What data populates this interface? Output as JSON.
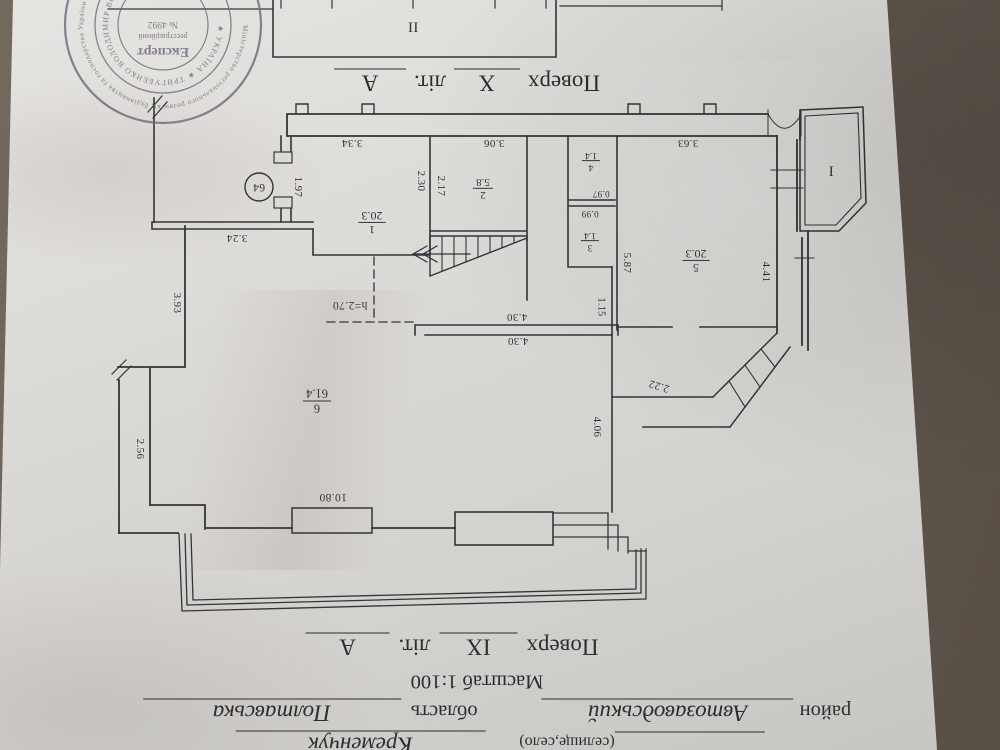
{
  "background": {
    "table_color": "#675e54",
    "paper_color": "#dcdad6",
    "ink_color": "#34343b",
    "stamp_color": "#6f6a7a"
  },
  "stamp": {
    "center_title": "Експерт",
    "center_sub": "реєстраційний",
    "center_number": "№ 4992",
    "inner_ring": "★ УКРАЇНА ★ ТРИГУБЕНКО ВОЛОДИМИР ВОЛОДИМИРОВИЧ",
    "outer_ring": "Міністерство регіонального розвитку, будівництва та господарства України • Атестаційна архітектурно-будівельна комісія •"
  },
  "captions": {
    "floor_x": {
      "word": "Поверх",
      "value": "X",
      "lit_word": "літ.",
      "lit_value": "А"
    },
    "floor_ix": {
      "word": "Поверх",
      "value": "IX",
      "lit_word": "літ.",
      "lit_value": "А"
    },
    "scale": "Масштаб 1:100",
    "district_word": "район",
    "district": "Автозаводський",
    "oblast_word": "область",
    "oblast": "Полтавська",
    "settlement_word": "(селище,село)",
    "settlement": "Кременчук"
  },
  "plan": {
    "apartment_number": "64",
    "balcony_bay": "I",
    "balcony_terrace": "II",
    "height_mark": "h=2.70",
    "rooms": [
      {
        "n": "1",
        "a": "20.3"
      },
      {
        "n": "2",
        "a": "5.8"
      },
      {
        "n": "3",
        "a": "1.4"
      },
      {
        "n": "4",
        "a": "1.4"
      },
      {
        "n": "5",
        "a": "20.3"
      },
      {
        "n": "6",
        "a": "61.4"
      }
    ],
    "dims": {
      "top1": "3.34",
      "top2": "3.06",
      "top3": "3.63",
      "left1": "1.97",
      "st1": "2.30",
      "st2": "2.17",
      "r4h": "0.97",
      "r3h": "0.99",
      "cor": "5.87",
      "r5r": "4.41",
      "v115": "1.15",
      "w430a": "4.30",
      "w430b": "4.30",
      "w324": "3.24",
      "v393": "3.93",
      "v256": "2.56",
      "v406": "4.06",
      "diag": "2.22",
      "w1080": "10.80"
    }
  }
}
